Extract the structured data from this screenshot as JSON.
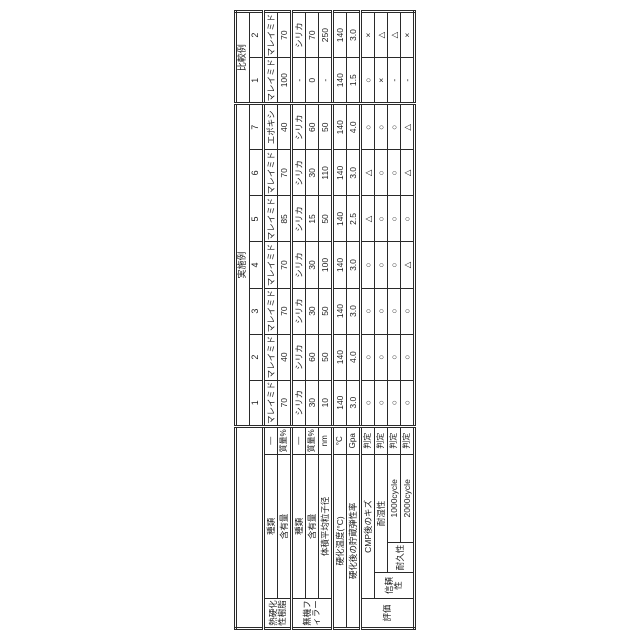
{
  "page": {
    "background": "#ffffff",
    "border_color": "#2a2a2a",
    "orientation": "table rotated 90deg CCW"
  },
  "table": {
    "corner_label": "",
    "column_groups": [
      {
        "label": "実施例",
        "columns": [
          "1",
          "2",
          "3",
          "4",
          "5",
          "6",
          "7"
        ]
      },
      {
        "label": "比較例",
        "columns": [
          "1",
          "2"
        ]
      }
    ],
    "rows": [
      {
        "group": "熱硬化性樹脂",
        "group_rowspan": 2,
        "label": "種類",
        "label_colspan": 3,
        "unit": "—",
        "values": [
          "マレイミド",
          "マレイミド",
          "マレイミド",
          "マレイミド",
          "マレイミド",
          "マレイミド",
          "エポキシ",
          "マレイミド",
          "マレイミド"
        ]
      },
      {
        "label": "含有量",
        "label_colspan": 3,
        "unit": "質量%",
        "values": [
          "70",
          "40",
          "70",
          "70",
          "85",
          "70",
          "40",
          "100",
          "70"
        ]
      },
      {
        "group": "無機フィラー",
        "group_rowspan": 3,
        "label": "種類",
        "label_colspan": 3,
        "unit": "—",
        "section_start": true,
        "values": [
          "シリカ",
          "シリカ",
          "シリカ",
          "シリカ",
          "シリカ",
          "シリカ",
          "シリカ",
          "-",
          "シリカ"
        ]
      },
      {
        "label": "含有量",
        "label_colspan": 3,
        "unit": "質量%",
        "values": [
          "30",
          "60",
          "30",
          "30",
          "15",
          "30",
          "60",
          "0",
          "70"
        ]
      },
      {
        "label": "体積平均粒子径",
        "label_colspan": 3,
        "unit": "nm",
        "values": [
          "10",
          "50",
          "50",
          "100",
          "50",
          "110",
          "50",
          "-",
          "250"
        ]
      },
      {
        "label": "硬化温度(°C)",
        "label_colspan": 4,
        "unit": "°C",
        "section_start": true,
        "values": [
          "140",
          "140",
          "140",
          "140",
          "140",
          "140",
          "140",
          "140",
          "140"
        ]
      },
      {
        "label": "硬化後の貯蔵弾性率",
        "label_colspan": 4,
        "unit": "Gpa",
        "values": [
          "3.0",
          "4.0",
          "3.0",
          "3.0",
          "2.5",
          "3.0",
          "4.0",
          "1.5",
          "3.0"
        ]
      },
      {
        "group": "評価",
        "group_rowspan": 4,
        "label": "CMP後のキズ",
        "label_colspan": 3,
        "unit": "判定",
        "section_start": true,
        "values": [
          "○",
          "○",
          "○",
          "○",
          "△",
          "△",
          "○",
          "○",
          "×"
        ]
      },
      {
        "sub": "信頼性",
        "sub_rowspan": 3,
        "label": "耐湿性",
        "label_colspan": 2,
        "unit": "判定",
        "values": [
          "○",
          "○",
          "○",
          "○",
          "○",
          "○",
          "○",
          "×",
          "△"
        ]
      },
      {
        "subsub": "耐久性",
        "subsub_rowspan": 2,
        "label": "1000cycle",
        "label_colspan": 1,
        "unit": "判定",
        "values": [
          "○",
          "○",
          "○",
          "○",
          "○",
          "○",
          "○",
          "-",
          "△"
        ]
      },
      {
        "label": "2000cycle",
        "label_colspan": 1,
        "unit": "判定",
        "values": [
          "○",
          "○",
          "○",
          "△",
          "○",
          "△",
          "△",
          "-",
          "×"
        ]
      }
    ],
    "layout": {
      "header_col_widths": [
        30,
        26,
        30,
        88,
        28
      ],
      "data_col_width": 46
    }
  }
}
